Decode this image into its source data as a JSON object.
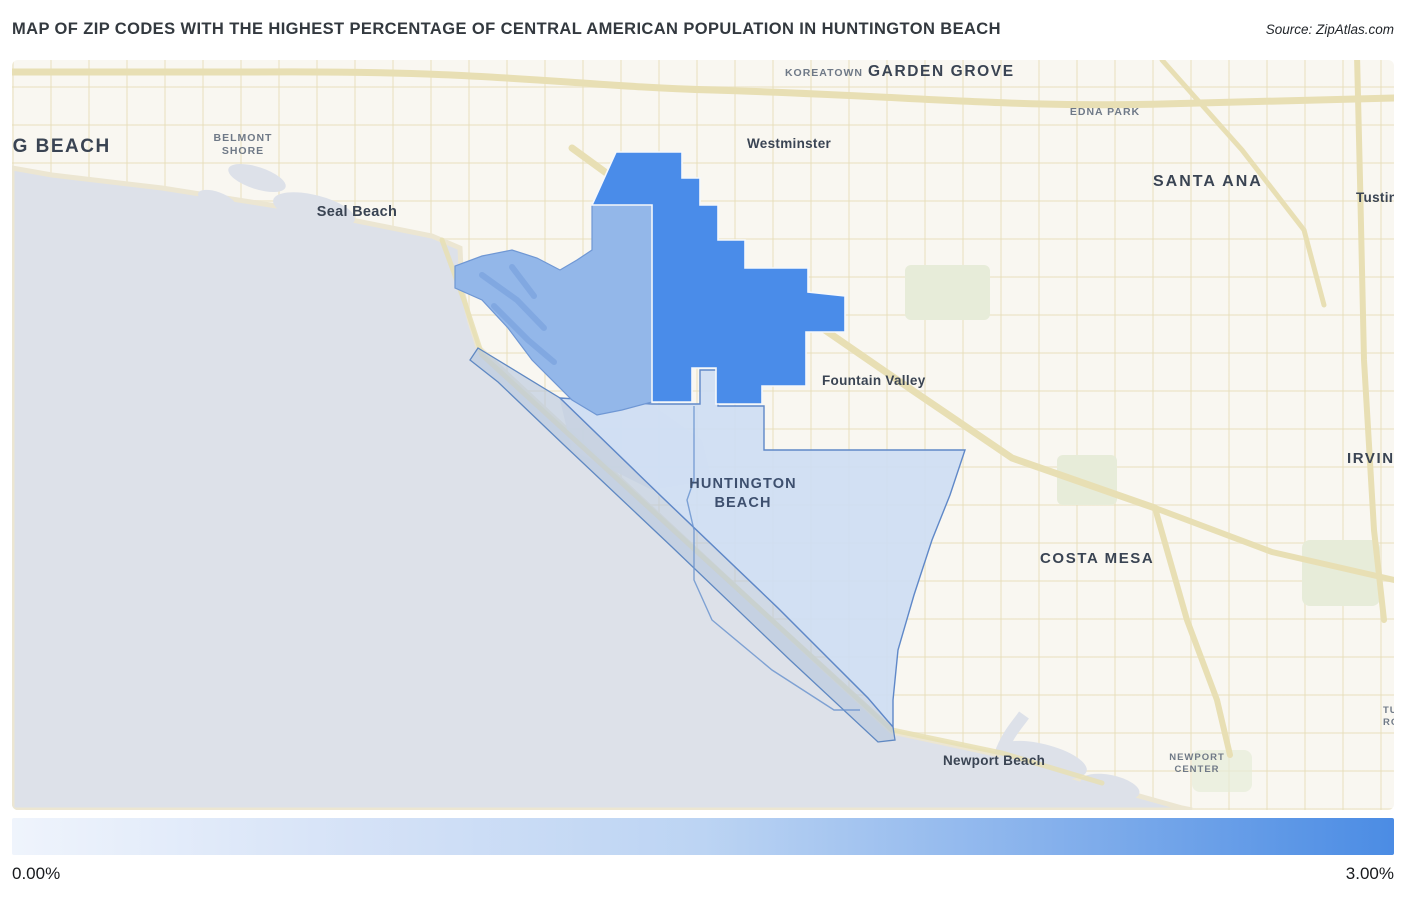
{
  "header": {
    "title": "MAP OF ZIP CODES WITH THE HIGHEST PERCENTAGE OF CENTRAL AMERICAN POPULATION IN HUNTINGTON BEACH",
    "source": "Source: ZipAtlas.com"
  },
  "map": {
    "labels": {
      "long_beach": "LONG BEACH",
      "belmont_shore": "BELMONT\nSHORE",
      "seal_beach": "Seal Beach",
      "koreatown": "KOREATOWN",
      "garden_grove": "GARDEN GROVE",
      "westminster": "Westminster",
      "edna_park": "EDNA PARK",
      "santa_ana": "SANTA ANA",
      "tustin": "Tustin",
      "fountain_valley": "Fountain Valley",
      "huntington_beach": "HUNTINGTON\nBEACH",
      "costa_mesa": "COSTA MESA",
      "irvine": "IRVINE",
      "newport_beach": "Newport Beach",
      "newport_center": "NEWPORT\nCENTER",
      "turtle_rock": "TURTLE\nROCK"
    },
    "regions": [
      {
        "name": "zip-highest-share",
        "shade": "#4a8ce9"
      },
      {
        "name": "zip-medium-share",
        "shade": "#93b7e9"
      },
      {
        "name": "zip-low-share",
        "shade": "#cfdef3"
      },
      {
        "name": "zip-coastal-strip",
        "shade": "#b7c6dd"
      }
    ],
    "base_colors": {
      "water": "#dde1e9",
      "land": "#f9f7f1",
      "road": "#e8dfb4",
      "park": "#e7ecd9"
    }
  },
  "legend": {
    "min_label": "0.00%",
    "max_label": "3.00%",
    "gradient_start": "#eff4fc",
    "gradient_end": "#4b8ce4"
  }
}
